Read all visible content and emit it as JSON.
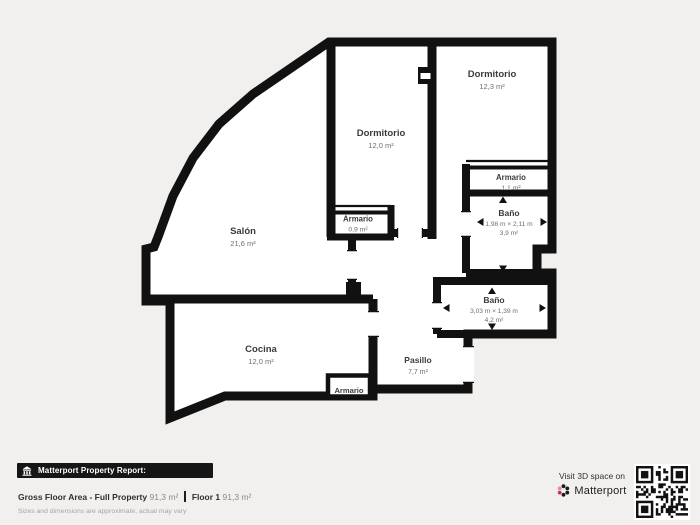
{
  "page": {
    "background_color": "#f2f0ee"
  },
  "plan": {
    "wall_color": "#111111",
    "room_fill": "#ffffff"
  },
  "rooms": [
    {
      "name": "Salón",
      "area": "21,6 m²"
    },
    {
      "name": "Dormitorio",
      "area": "12,0 m²"
    },
    {
      "name": "Dormitorio",
      "area": "12,3 m²"
    },
    {
      "name": "Armario",
      "area": "1,1 m²"
    },
    {
      "name": "Baño",
      "dims": "1,98 m × 2,11 m",
      "area": "3,9 m²"
    },
    {
      "name": "Baño",
      "dims": "3,03 m × 1,39 m",
      "area": "4,2 m²"
    },
    {
      "name": "Pasillo",
      "area": "7,7 m²"
    },
    {
      "name": "Cocina",
      "area": "12,0 m²"
    },
    {
      "name": "Armario",
      "area": "0,9 m²"
    },
    {
      "name": "Armario"
    }
  ],
  "footer": {
    "report_title": "Matterport Property Report:",
    "gross_label": "Gross Floor Area - Full Property",
    "gross_value": "91,3 m²",
    "floor_label": "Floor 1",
    "floor_value": "91,3 m²",
    "disclaimer": "Sizes and dimensions are approximate, actual may vary"
  },
  "visit": {
    "caption": "Visit 3D space on",
    "brand": "Matterport",
    "brand_red": "#cb2e55"
  }
}
